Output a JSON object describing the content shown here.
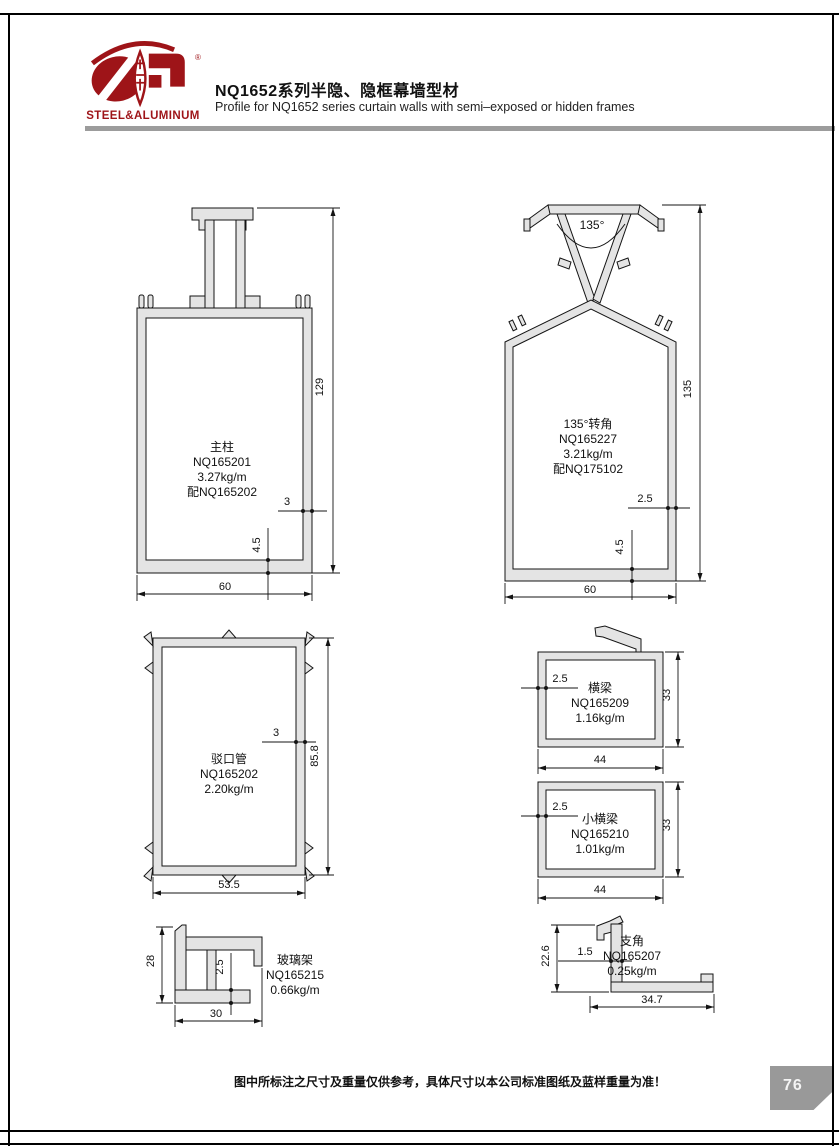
{
  "header": {
    "logo": {
      "text": "STEEL&ALUMINUM",
      "mark": "®"
    },
    "title_cn": "NQ1652系列半隐、隐框幕墙型材",
    "title_en": "Profile for NQ1652 series curtain walls with semi–exposed or hidden frames"
  },
  "profiles": {
    "mullion": {
      "name": "主柱",
      "code": "NQ165201",
      "weight": "3.27kg/m",
      "pair": "配NQ165202",
      "dims": {
        "height": "129",
        "width": "60",
        "wall": "3",
        "bottom_wall": "4.5"
      }
    },
    "corner": {
      "name": "135°转角",
      "code": "NQ165227",
      "weight": "3.21kg/m",
      "pair": "配NQ175102",
      "dims": {
        "angle": "135°",
        "height": "135",
        "width": "60",
        "wall": "2.5",
        "bottom_wall": "4.5"
      }
    },
    "joint_tube": {
      "name": "驳口管",
      "code": "NQ165202",
      "weight": "2.20kg/m",
      "dims": {
        "height": "85.8",
        "width": "53.5",
        "wall": "3"
      }
    },
    "beam": {
      "name": "横梁",
      "code": "NQ165209",
      "weight": "1.16kg/m",
      "dims": {
        "height": "33",
        "width": "44",
        "wall": "2.5"
      }
    },
    "small_beam": {
      "name": "小横梁",
      "code": "NQ165210",
      "weight": "1.01kg/m",
      "dims": {
        "height": "33",
        "width": "44",
        "wall": "2.5"
      }
    },
    "glass_rack": {
      "name": "玻璃架",
      "code": "NQ165215",
      "weight": "0.66kg/m",
      "dims": {
        "height": "28",
        "width": "30",
        "wall": "2.5"
      }
    },
    "bracket": {
      "name": "支角",
      "code": "NQ165207",
      "weight": "0.25kg/m",
      "dims": {
        "height": "22.6",
        "width": "34.7",
        "wall": "1.5"
      }
    }
  },
  "footer": {
    "disclaimer": "图中所标注之尺寸及重量仅供参考，具体尺寸以本公司标准图纸及蓝样重量为准！",
    "page_number": "76"
  },
  "colors": {
    "brand_red": "#9e1418",
    "profile_fill": "#e4e4e4",
    "line": "#141414",
    "divider_gray": "#9c9c9c",
    "page_tab": "#999999"
  }
}
